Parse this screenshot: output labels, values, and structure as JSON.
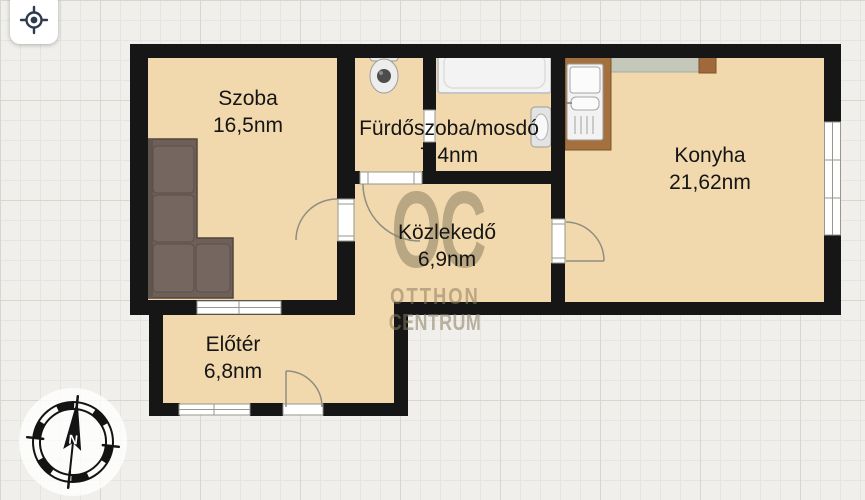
{
  "toolbar": {
    "locate_icon": "crosshair-locate"
  },
  "rooms": [
    {
      "name": "Szoba",
      "area": "16,5nm"
    },
    {
      "name": "Fürdőszoba/mosdó",
      "area": "7,4nm"
    },
    {
      "name": "Konyha",
      "area": "21,62nm"
    },
    {
      "name": "Közlekedő",
      "area": "6,9nm"
    },
    {
      "name": "Előtér",
      "area": "6,8nm"
    }
  ],
  "watermark": {
    "monogram": "OC",
    "line1": "OTTHON",
    "line2": "CENTRUM"
  },
  "compass": {
    "north_label": "N"
  },
  "colors": {
    "floor": "#f2d9ad",
    "wall": "#161616",
    "background": "#f0efec",
    "watermark": "#8a7c60",
    "icon_accent": "#2e3c4e"
  }
}
